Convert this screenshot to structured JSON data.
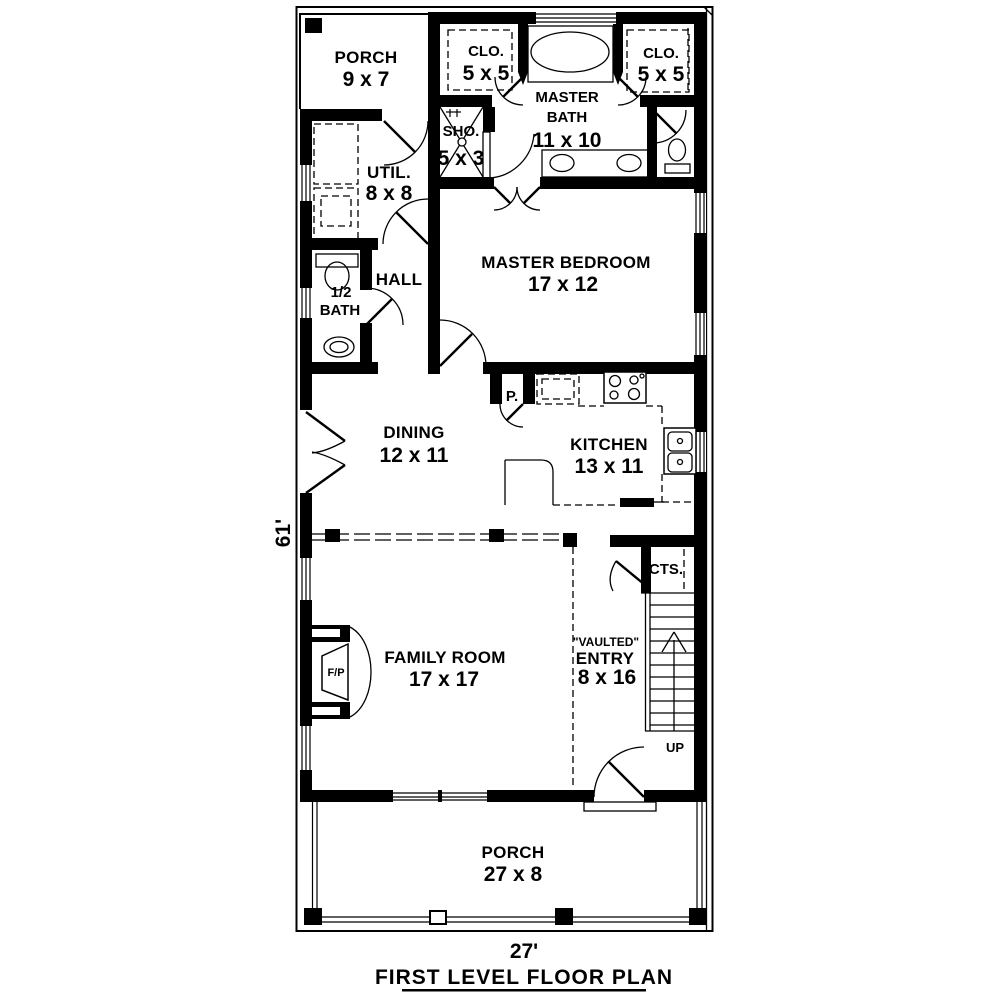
{
  "title": "FIRST LEVEL FLOOR PLAN",
  "dimensions": {
    "overall_depth": "61'",
    "overall_width": "27'"
  },
  "rooms": {
    "porch_top": {
      "name": "PORCH",
      "size": "9 x 7"
    },
    "closet_left": {
      "name": "CLO.",
      "size": "5 x 5"
    },
    "closet_right": {
      "name": "CLO.",
      "size": "5 x 5"
    },
    "master_bath": {
      "name_line1": "MASTER",
      "name_line2": "BATH",
      "size": "11 x 10"
    },
    "shower": {
      "name": "SHO.",
      "size": "5 x 3"
    },
    "utility": {
      "name": "UTIL.",
      "size": "8 x 8"
    },
    "master_bedroom": {
      "name": "MASTER BEDROOM",
      "size": "17 x 12"
    },
    "hall": {
      "name": "HALL"
    },
    "half_bath": {
      "name_line1": "1/2",
      "name_line2": "BATH"
    },
    "dining": {
      "name": "DINING",
      "size": "12 x 11"
    },
    "pantry": {
      "name": "P."
    },
    "kitchen": {
      "name": "KITCHEN",
      "size": "13 x 11"
    },
    "stair_closet": {
      "name": "CTS."
    },
    "entry": {
      "name_line1": "\"VAULTED\"",
      "name_line2": "ENTRY",
      "size": "8 x 16"
    },
    "family_room": {
      "name": "FAMILY ROOM",
      "size": "17 x 17"
    },
    "fireplace": {
      "name": "F/P"
    },
    "stairs": {
      "direction": "UP"
    },
    "porch_bottom": {
      "name": "PORCH",
      "size": "27 x 8"
    }
  },
  "colors": {
    "ink": "#000000",
    "paper": "#ffffff"
  }
}
